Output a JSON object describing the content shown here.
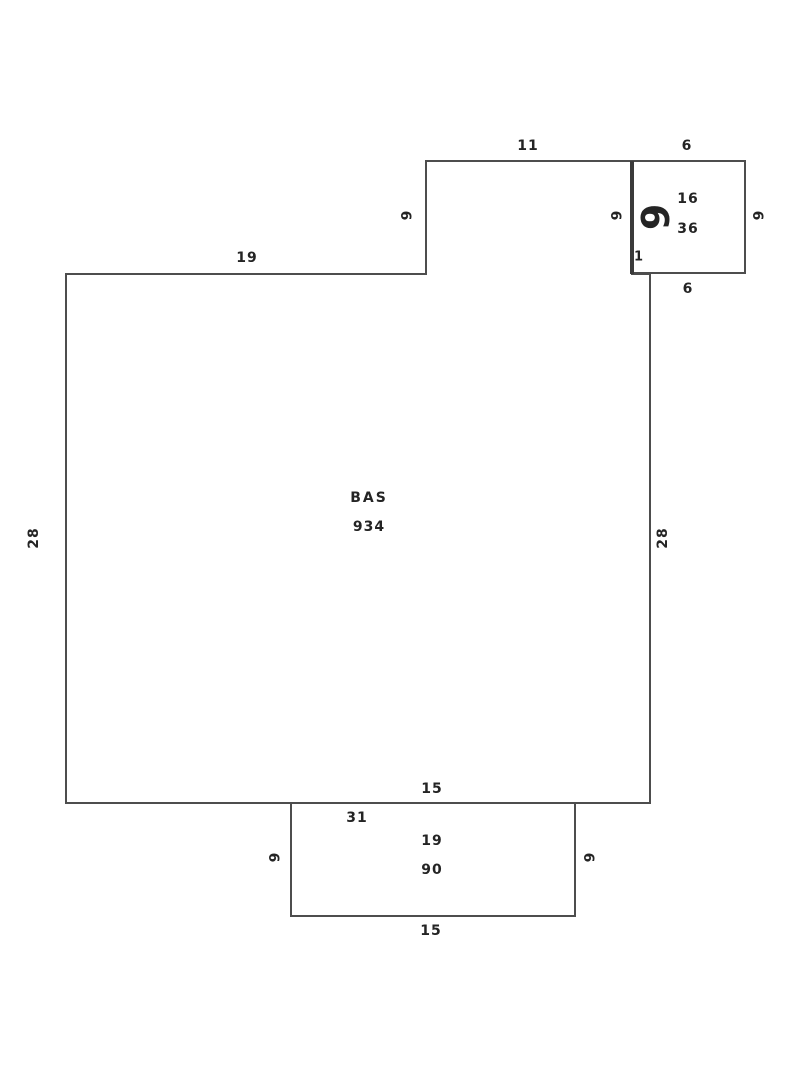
{
  "colors": {
    "line": "#4d4d4d",
    "thick_line": "#3a3a3a",
    "text": "#242424",
    "background": "#ffffff"
  },
  "main_area": {
    "name": "BAS",
    "area": "934"
  },
  "top_right_square": {
    "interior_line1": "16",
    "interior_line2": "36",
    "big_side_dim": "6"
  },
  "bottom_rectangle": {
    "interior_line1": "19",
    "interior_line2": "90"
  },
  "labels": {
    "top_11": "11",
    "square_top_6": "6",
    "left_19": "19",
    "notch_6": "6",
    "inner_6": "6",
    "big_6": "6",
    "square_16": "16",
    "square_36": "36",
    "square_right_6": "6",
    "jog_1": "1",
    "square_bottom_6": "6",
    "left_28": "28",
    "right_28": "28",
    "bas_name": "BAS",
    "bas_area": "934",
    "bottom_15_top": "15",
    "bottom_31": "31",
    "rect_19": "19",
    "rect_90": "90",
    "rect_left_6": "6",
    "rect_right_6": "6",
    "bottom_15": "15"
  }
}
